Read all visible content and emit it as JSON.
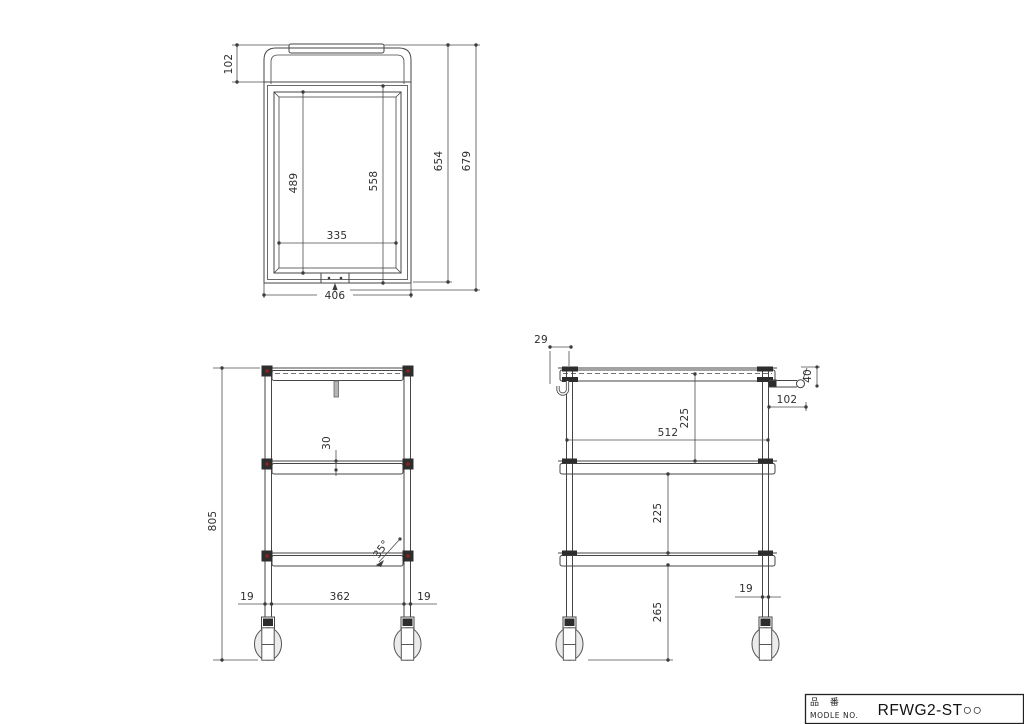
{
  "title_block": {
    "part_label_jp": "品 番",
    "part_label_en": "MODLE NO.",
    "model_no": "RFWG2-ST○○"
  },
  "top_view": {
    "dim_handle_depth": "102",
    "dim_inner_length": "489",
    "dim_frame_length": "558",
    "dim_body_length": "654",
    "dim_total_length": "679",
    "dim_inner_width": "335",
    "dim_outer_width": "406"
  },
  "front_view": {
    "dim_total_height": "805",
    "dim_shelf_lip": "30",
    "dim_caster_angle": "35°",
    "dim_left_offset": "19",
    "dim_leg_span": "362",
    "dim_right_offset": "19"
  },
  "side_view": {
    "dim_hook_offset": "29",
    "dim_handle_height": "40",
    "dim_handle_length": "102",
    "dim_shelf_gap_top": "225",
    "dim_depth": "512",
    "dim_shelf_gap_bottom": "225",
    "dim_bottom_clearance": "265",
    "dim_post_dia": "19"
  },
  "colors": {
    "line": "#454545",
    "clamp_red": "#8b2222",
    "dark_fill": "#2d2d2d"
  }
}
